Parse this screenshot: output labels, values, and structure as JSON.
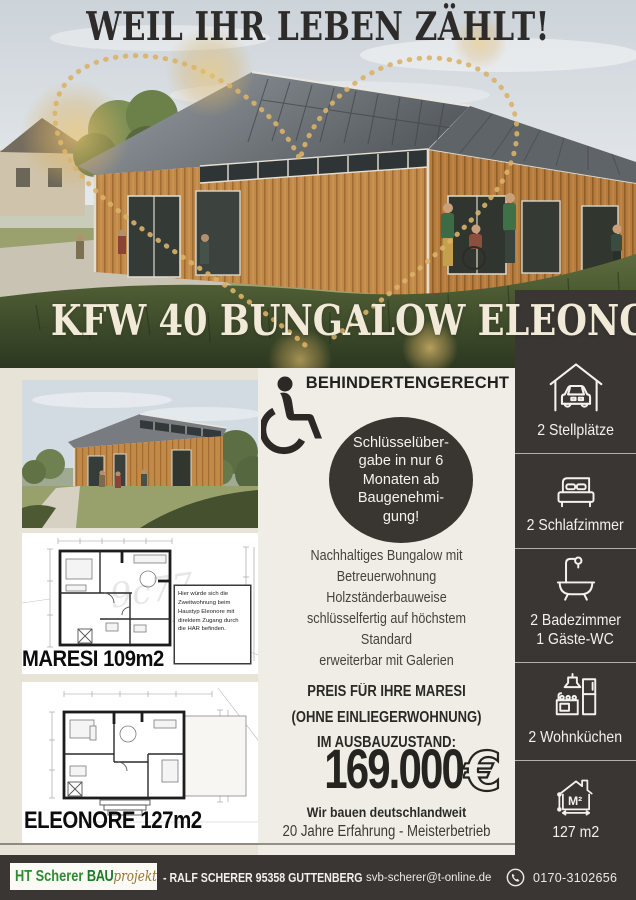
{
  "page": {
    "title": "WEIL IHR LEBEN ZÄHLT!",
    "banner": "KFW 40 BUNGALOW ELEONORE"
  },
  "middle": {
    "heading": "BEHINDERTENGERECHT",
    "badge_lines": [
      "Schlüsselüber-",
      "gabe in nur 6",
      "Monaten ab",
      "Baugenehmi-",
      "gung!"
    ],
    "description_lines": [
      "Nachhaltiges Bungalow mit",
      "Betreuerwohnung",
      "Holzständerbauweise",
      "schlüsselfertig auf höchstem",
      "Standard",
      "erweiterbar mit Galerien"
    ],
    "price_line1": "PREIS FÜR IHRE MARESI",
    "price_line2": "(OHNE EINLIEGERWOHNUNG)",
    "price_line3": "IM AUSBAUZUSTAND:",
    "price_value": "169.000",
    "price_currency": "€",
    "note_bold": "Wir bauen deutschlandweit",
    "note": "20 Jahre Erfahrung - Meisterbetrieb"
  },
  "plans": {
    "maresi": {
      "label": "MARESI 109m2",
      "annotation": "Hier würde sich die Zweitwohnung beim Haustyp Eleonore mit direktem Zugang durch die HAR befinden.",
      "watermark": "9c77"
    },
    "eleonore": {
      "label": "ELEONORE 127m2"
    }
  },
  "sidebar": {
    "items": [
      {
        "icon": "carport-icon",
        "lines": [
          "2 Stellplätze"
        ]
      },
      {
        "icon": "bed-icon",
        "lines": [
          "2 Schlafzimmer"
        ]
      },
      {
        "icon": "bathtub-icon",
        "lines": [
          "2 Badezimmer",
          "1 Gäste-WC"
        ]
      },
      {
        "icon": "kitchen-icon",
        "lines": [
          "2 Wohnküchen"
        ]
      },
      {
        "icon": "area-icon",
        "icon_text": "M²",
        "lines": [
          "127 m2"
        ]
      }
    ]
  },
  "footer": {
    "logo_part1": "HT Scherer ",
    "logo_part2": "BAU",
    "logo_part3": "projekt",
    "company_line": "- RALF SCHERER 95358 GUTTENBERG",
    "email": "svb-scherer@t-online.de",
    "phone": "0170-3102656"
  },
  "colors": {
    "dark_panel": "#3a3633",
    "cream": "#efede5",
    "gold": "#d9b267",
    "banner_text": "#f1ead8",
    "logo_green": "#2e8b34",
    "price_black": "#262421"
  }
}
